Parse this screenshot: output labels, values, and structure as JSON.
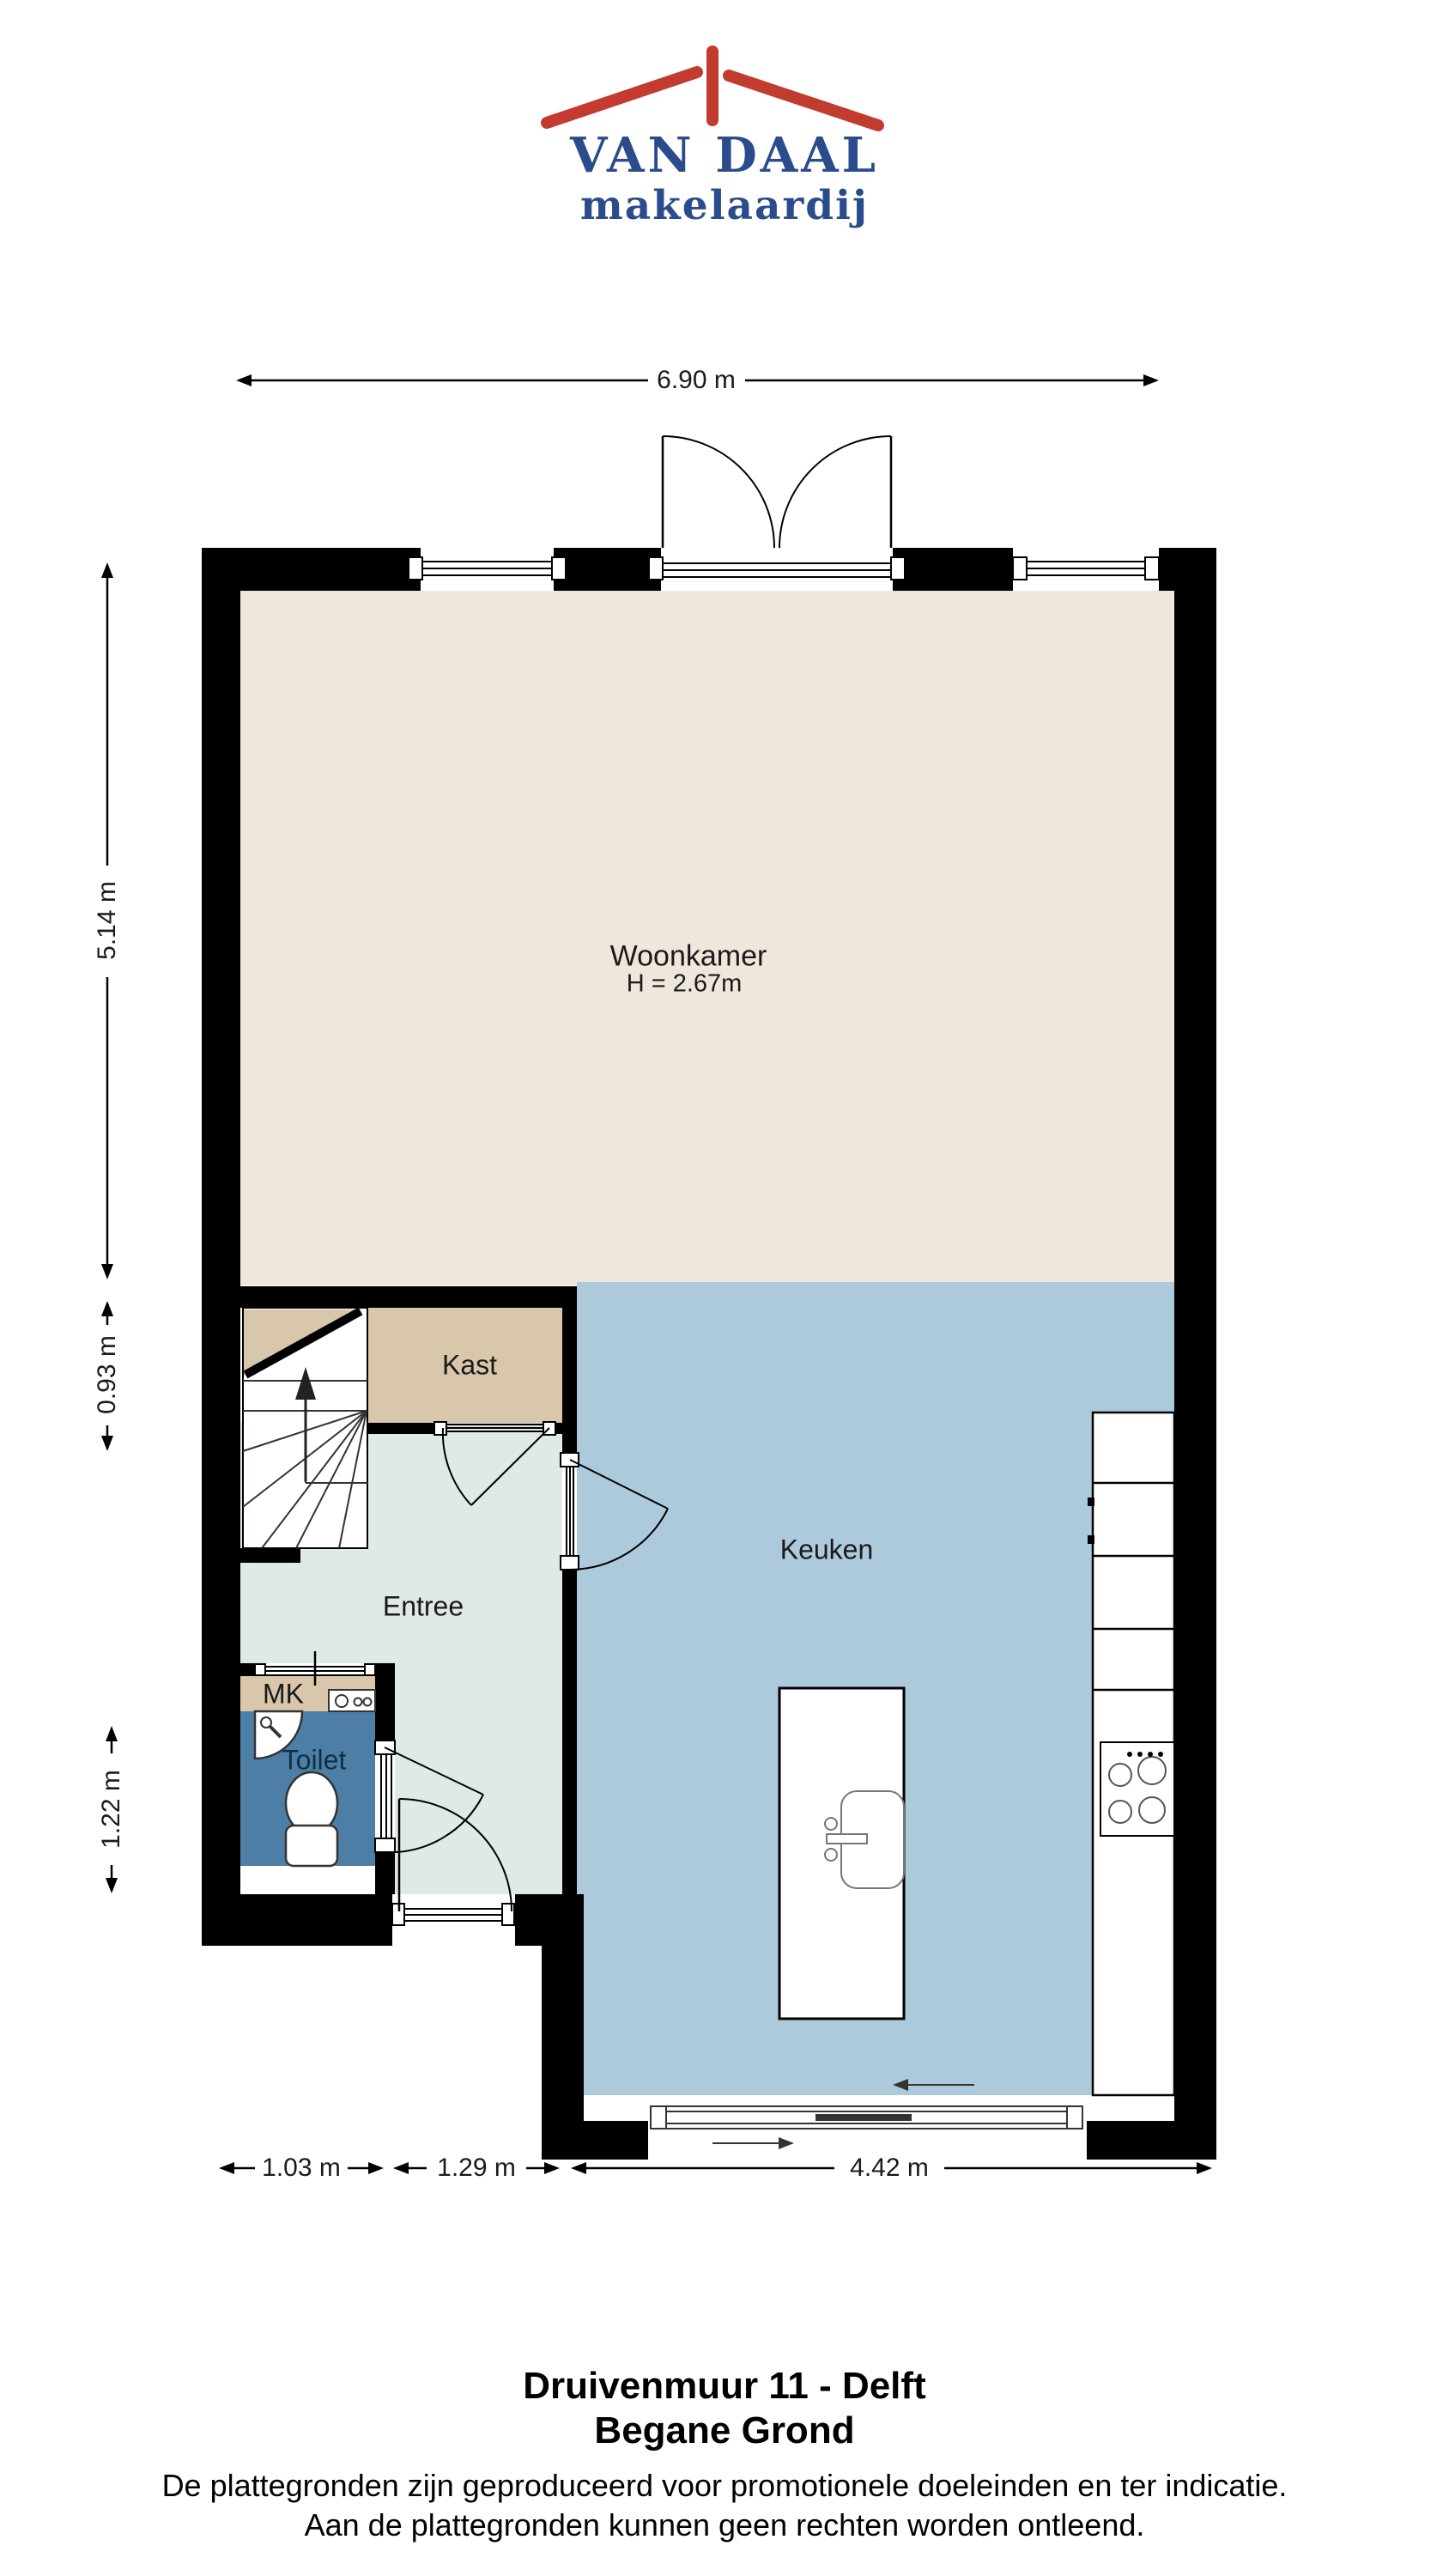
{
  "logo": {
    "name": "VAN DAAL",
    "tagline": "makelaardij"
  },
  "rooms": {
    "woonkamer": "Woonkamer",
    "woonkamer_height": "H = 2.67m",
    "kast": "Kast",
    "entree": "Entree",
    "mk": "MK",
    "toilet": "Toilet",
    "keuken": "Keuken"
  },
  "dimensions": {
    "top_width": "6.90 m",
    "left_upper": "5.14 m",
    "left_mid": "0.93 m",
    "left_lower": "1.22 m",
    "bottom_left": "1.03 m",
    "bottom_mid": "1.29 m",
    "bottom_right": "4.42 m"
  },
  "footer": {
    "title": "Druivenmuur 11 - Delft",
    "subtitle": "Begane Grond",
    "disclaimer1": "De plattegronden zijn geproduceerd voor promotionele doeleinden en ter indicatie.",
    "disclaimer2": "Aan de plattegronden kunnen geen rechten worden ontleend."
  },
  "colors": {
    "walls": "#000000",
    "woonkamer": "#F0E7DC",
    "kast": "#D8C7AB",
    "entree": "#DFE9E7",
    "keuken": "#ADCADC",
    "toilet": "#4D7FA6",
    "logo_red": "#C23B2E",
    "logo_blue": "#2B4C8C"
  }
}
